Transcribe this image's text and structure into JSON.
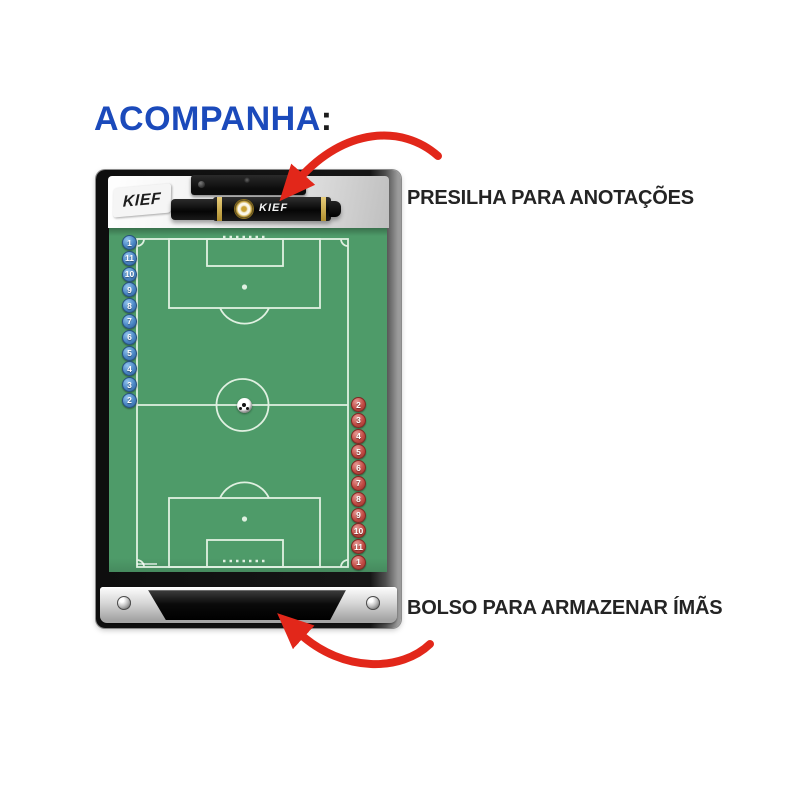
{
  "title": {
    "text": "ACOMPANHA",
    "colon": ":"
  },
  "callouts": {
    "clip": "PRESILHA PARA ANOTAÇÕES",
    "pocket": "BOLSO PARA ARMAZENAR ÍMÃS"
  },
  "board": {
    "brand_logo": "KIEF",
    "pen_brand": "KIEF",
    "blue_magnets": [
      "1",
      "11",
      "10",
      "9",
      "8",
      "7",
      "6",
      "5",
      "4",
      "3",
      "2"
    ],
    "red_magnets": [
      "2",
      "3",
      "4",
      "5",
      "6",
      "7",
      "8",
      "9",
      "10",
      "11",
      "1"
    ]
  },
  "colors": {
    "title_blue": "#1b4abb",
    "label_dark": "#242424",
    "arrow_red": "#e2271a",
    "field_green": "#4e9b69",
    "field_line": "#e8f5e8",
    "magnet_blue": "#4a86c4",
    "magnet_red": "#c14b44"
  }
}
